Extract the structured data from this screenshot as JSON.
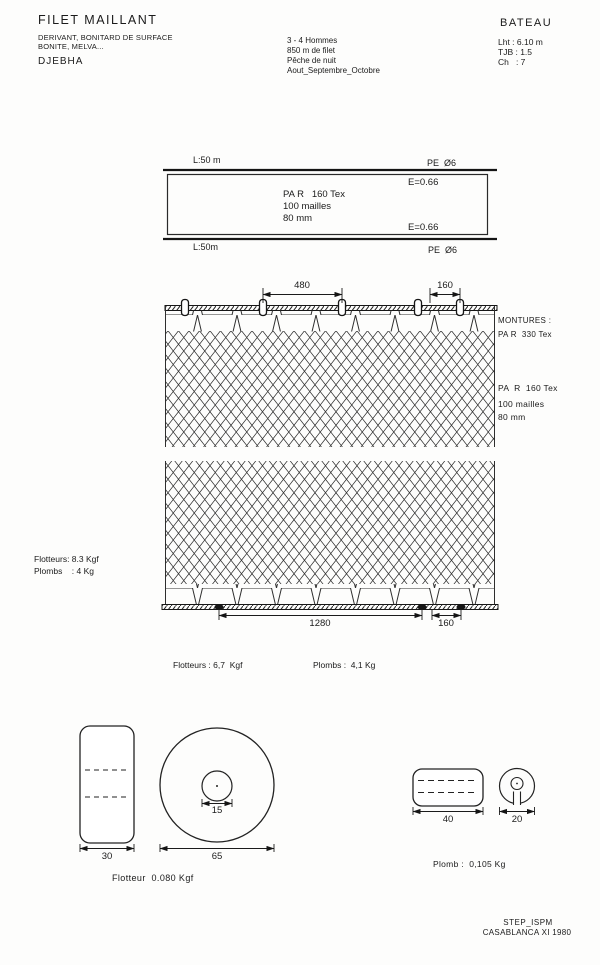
{
  "colors": {
    "ink": "#1b1b1b",
    "paper": "#fdfdfc"
  },
  "header": {
    "title": "FILET MAILLANT",
    "subtitle_line1": "DERIVANT, BONITARD DE SURFACE",
    "subtitle_line2": "BONITE, MELVA...",
    "port": "DJEBHA",
    "crew": "3 - 4 Hommes",
    "net_length": "850 m de filet",
    "fishing_mode": "Pêche de nuit",
    "season": "Aout_Septembre_Octobre",
    "boat": {
      "title": "BATEAU",
      "length": "Lht : 6.10 m",
      "tonnage": "TJB : 1.5",
      "power": "Ch   : 7"
    }
  },
  "schematic": {
    "length_top": "L:50 m",
    "rope_top": "PE  Ø6",
    "hanging_ratio_top": "E=0.66",
    "twine": "PA R   160 Tex",
    "depth": "100 mailles",
    "mesh_size": "80 mm",
    "hanging_ratio_bottom": "E=0.66",
    "length_bottom": "L:50m",
    "rope_bottom": "PE  Ø6"
  },
  "net_panel": {
    "dim_float_spacing": "480",
    "dim_float_spacing_small": "160",
    "montures_label": "MONTURES :",
    "montures_value": "PA R  330 Tex",
    "twine": "PA  R  160 Tex",
    "depth": "100 mailles",
    "mesh_size": "80 mm",
    "buoyancy": "Flotteurs: 8.3 Kgf",
    "ballast": "Plombs    : 4 Kg",
    "dim_sinker_spacing": "1280",
    "dim_sinker_spacing_small": "160",
    "buoyancy_total": "Flotteurs : 6,7  Kgf",
    "ballast_total": "Plombs :  4,1 Kg"
  },
  "float_detail": {
    "width": "30",
    "core_diameter": "15",
    "outer_diameter": "65",
    "label": "Flotteur  0.080 Kgf"
  },
  "sinker_detail": {
    "width": "40",
    "diameter": "20",
    "label": "Plomb :  0,105 Kg"
  },
  "footer": {
    "org": "STEP_ISPM",
    "place": "CASABLANCA XI 1980"
  }
}
